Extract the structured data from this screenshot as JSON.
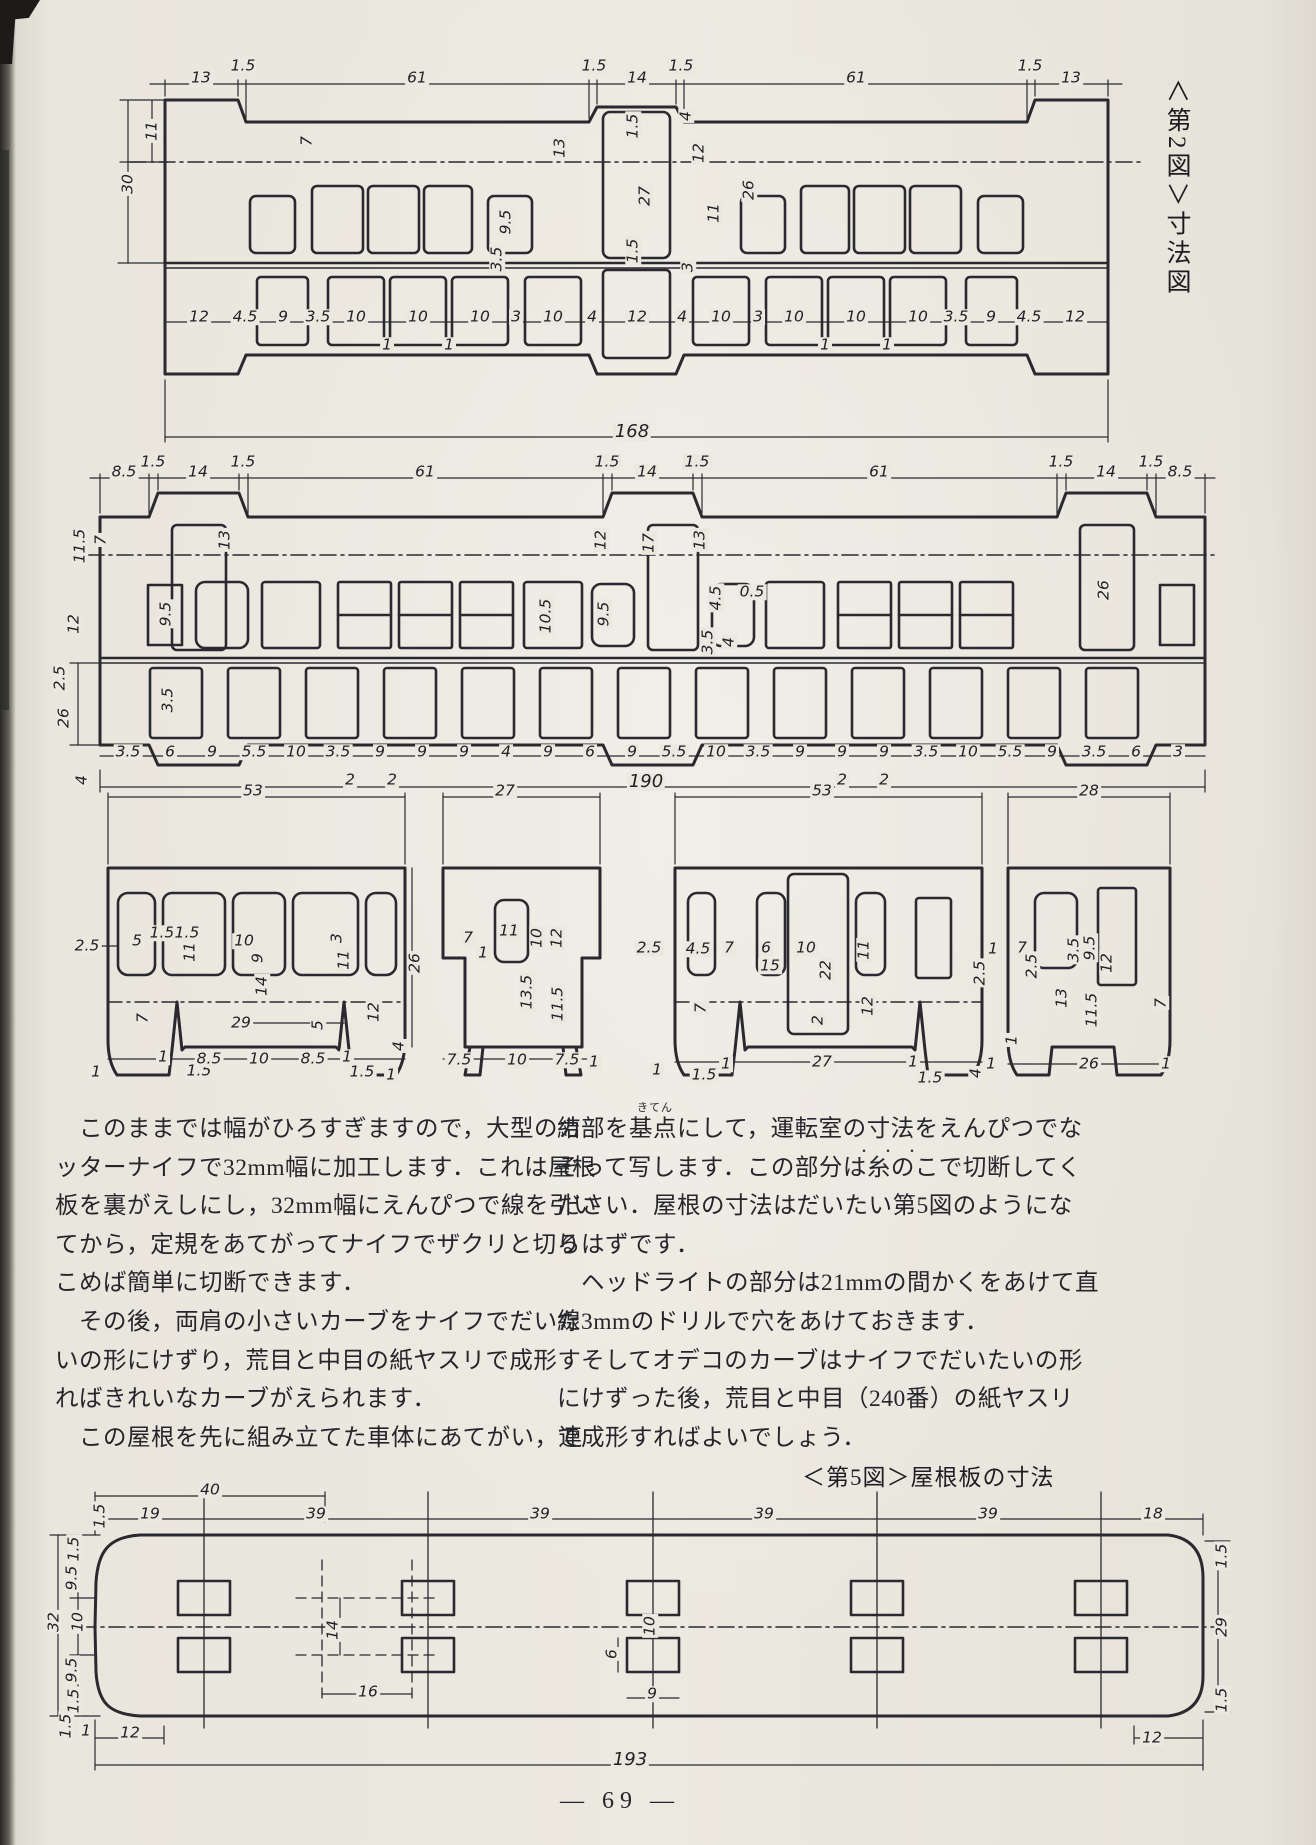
{
  "page": {
    "footer": "— 69 —",
    "ink": "#2a2930",
    "paper": "#e9e6dd"
  },
  "captions": {
    "fig2_vertical": "＜第2図＞寸法図",
    "fig5": "＜第5図＞屋根板の寸法"
  },
  "text": {
    "left_col": [
      "　このままでは幅がひろすぎますので，大型のカ",
      "ッターナイフで32mm幅に加工します．これは屋根",
      "板を裏がえしにし，32mm幅にえんぴつで線を引い",
      "てから，定規をあてがってナイフでザクリと切り",
      "こめば簡単に切断できます．",
      "　その後，両肩の小さいカーブをナイフでだいた",
      "いの形にけずり，荒目と中目の紙ヤスリで成形す",
      "ればきれいなカーブがえられます．",
      "　この屋根を先に組み立てた車体にあてがい，連"
    ],
    "right_col": [
      "結部を基点にして，運転室の寸法をえんぴつでな",
      "ぞって写します．この部分は糸のこで切断してく",
      "ださい．屋根の寸法はだいたい第5図のようにな",
      "るはずです．",
      "　ヘッドライトの部分は21mmの間かくをあけて直",
      "線3mmのドリルで穴をあけておきます．",
      "　そしてオデコのカーブはナイフでだいたいの形",
      "にけずった後，荒目と中目（240番）の紙ヤスリ",
      "で成形すればよいでしょう．"
    ],
    "furigana_kiten": "きてん",
    "emphasis_dots": "・・・"
  },
  "dims": {
    "strip1": [
      {
        "t": "13",
        "x": 201,
        "y": 78
      },
      {
        "t": "1.5",
        "x": 243,
        "y": 66
      },
      {
        "t": "61",
        "x": 417,
        "y": 78
      },
      {
        "t": "1.5",
        "x": 594,
        "y": 66
      },
      {
        "t": "14",
        "x": 637,
        "y": 78
      },
      {
        "t": "1.5",
        "x": 681,
        "y": 66
      },
      {
        "t": "61",
        "x": 856,
        "y": 78
      },
      {
        "t": "1.5",
        "x": 1030,
        "y": 66
      },
      {
        "t": "13",
        "x": 1071,
        "y": 78
      },
      {
        "t": "11",
        "x": 152,
        "y": 131,
        "r": 1
      },
      {
        "t": "30",
        "x": 128,
        "y": 184,
        "r": 1
      },
      {
        "t": "7",
        "x": 307,
        "y": 141,
        "r": 1
      },
      {
        "t": "13",
        "x": 560,
        "y": 148,
        "r": 1
      },
      {
        "t": "9.5",
        "x": 506,
        "y": 222,
        "r": 1
      },
      {
        "t": "3.5",
        "x": 497,
        "y": 259,
        "r": 1
      },
      {
        "t": "1.5",
        "x": 633,
        "y": 126,
        "r": 1
      },
      {
        "t": "27",
        "x": 645,
        "y": 196,
        "r": 1
      },
      {
        "t": "1.5",
        "x": 633,
        "y": 251,
        "r": 1
      },
      {
        "t": "4",
        "x": 686,
        "y": 116,
        "r": 1
      },
      {
        "t": "12",
        "x": 699,
        "y": 153,
        "r": 1
      },
      {
        "t": "11",
        "x": 714,
        "y": 213,
        "r": 1
      },
      {
        "t": "26",
        "x": 749,
        "y": 190,
        "r": 1
      },
      {
        "t": "3",
        "x": 688,
        "y": 267,
        "r": 1
      },
      {
        "t": "12",
        "x": 199,
        "y": 317
      },
      {
        "t": "4.5",
        "x": 245,
        "y": 317
      },
      {
        "t": "9",
        "x": 283,
        "y": 317
      },
      {
        "t": "3.5",
        "x": 318,
        "y": 317
      },
      {
        "t": "10",
        "x": 356,
        "y": 317
      },
      {
        "t": "10",
        "x": 418,
        "y": 317
      },
      {
        "t": "10",
        "x": 480,
        "y": 317
      },
      {
        "t": "3",
        "x": 516,
        "y": 317
      },
      {
        "t": "10",
        "x": 553,
        "y": 317
      },
      {
        "t": "4",
        "x": 592,
        "y": 317
      },
      {
        "t": "12",
        "x": 637,
        "y": 317
      },
      {
        "t": "4",
        "x": 682,
        "y": 317
      },
      {
        "t": "10",
        "x": 721,
        "y": 317
      },
      {
        "t": "3",
        "x": 758,
        "y": 317
      },
      {
        "t": "10",
        "x": 794,
        "y": 317
      },
      {
        "t": "10",
        "x": 856,
        "y": 317
      },
      {
        "t": "10",
        "x": 918,
        "y": 317
      },
      {
        "t": "3.5",
        "x": 956,
        "y": 317
      },
      {
        "t": "9",
        "x": 991,
        "y": 317
      },
      {
        "t": "4.5",
        "x": 1029,
        "y": 317
      },
      {
        "t": "12",
        "x": 1075,
        "y": 317
      },
      {
        "t": "1",
        "x": 387,
        "y": 345
      },
      {
        "t": "1",
        "x": 449,
        "y": 345
      },
      {
        "t": "1",
        "x": 825,
        "y": 345
      },
      {
        "t": "1",
        "x": 887,
        "y": 345
      },
      {
        "t": "168",
        "x": 632,
        "y": 432,
        "s": 1
      }
    ],
    "strip2": [
      {
        "t": "8.5",
        "x": 124,
        "y": 472
      },
      {
        "t": "1.5",
        "x": 153,
        "y": 462
      },
      {
        "t": "14",
        "x": 198,
        "y": 472
      },
      {
        "t": "1.5",
        "x": 243,
        "y": 462
      },
      {
        "t": "61",
        "x": 425,
        "y": 472
      },
      {
        "t": "1.5",
        "x": 607,
        "y": 462
      },
      {
        "t": "14",
        "x": 647,
        "y": 472
      },
      {
        "t": "1.5",
        "x": 697,
        "y": 462
      },
      {
        "t": "61",
        "x": 879,
        "y": 472
      },
      {
        "t": "1.5",
        "x": 1061,
        "y": 462
      },
      {
        "t": "14",
        "x": 1106,
        "y": 472
      },
      {
        "t": "1.5",
        "x": 1151,
        "y": 462
      },
      {
        "t": "8.5",
        "x": 1180,
        "y": 472
      },
      {
        "t": "11.5",
        "x": 80,
        "y": 546,
        "r": 1
      },
      {
        "t": "7",
        "x": 101,
        "y": 540,
        "r": 1
      },
      {
        "t": "13",
        "x": 225,
        "y": 540,
        "r": 1
      },
      {
        "t": "12",
        "x": 74,
        "y": 624,
        "r": 1
      },
      {
        "t": "2.5",
        "x": 60,
        "y": 678,
        "r": 1
      },
      {
        "t": "9.5",
        "x": 166,
        "y": 614,
        "r": 1
      },
      {
        "t": "3.5",
        "x": 168,
        "y": 700,
        "r": 1
      },
      {
        "t": "26",
        "x": 64,
        "y": 718,
        "r": 1
      },
      {
        "t": "4",
        "x": 82,
        "y": 780,
        "r": 1
      },
      {
        "t": "12",
        "x": 601,
        "y": 540,
        "r": 1
      },
      {
        "t": "17",
        "x": 649,
        "y": 543,
        "r": 1
      },
      {
        "t": "13",
        "x": 700,
        "y": 540,
        "r": 1
      },
      {
        "t": "10.5",
        "x": 546,
        "y": 616,
        "r": 1
      },
      {
        "t": "9.5",
        "x": 604,
        "y": 614,
        "r": 1
      },
      {
        "t": "4.5",
        "x": 716,
        "y": 598,
        "r": 1
      },
      {
        "t": "0.5",
        "x": 752,
        "y": 592
      },
      {
        "t": "3.5",
        "x": 708,
        "y": 642,
        "r": 1
      },
      {
        "t": "4",
        "x": 729,
        "y": 642,
        "r": 1
      },
      {
        "t": "26",
        "x": 1104,
        "y": 590,
        "r": 1
      },
      {
        "t": "3.5",
        "x": 128,
        "y": 752
      },
      {
        "t": "6",
        "x": 170,
        "y": 752
      },
      {
        "t": "9",
        "x": 212,
        "y": 752
      },
      {
        "t": "5.5",
        "x": 254,
        "y": 752
      },
      {
        "t": "10",
        "x": 296,
        "y": 752
      },
      {
        "t": "3.5",
        "x": 338,
        "y": 752
      },
      {
        "t": "9",
        "x": 380,
        "y": 752
      },
      {
        "t": "9",
        "x": 422,
        "y": 752
      },
      {
        "t": "9",
        "x": 464,
        "y": 752
      },
      {
        "t": "4",
        "x": 506,
        "y": 752
      },
      {
        "t": "9",
        "x": 548,
        "y": 752
      },
      {
        "t": "6",
        "x": 590,
        "y": 752
      },
      {
        "t": "9",
        "x": 632,
        "y": 752
      },
      {
        "t": "5.5",
        "x": 674,
        "y": 752
      },
      {
        "t": "10",
        "x": 716,
        "y": 752
      },
      {
        "t": "3.5",
        "x": 758,
        "y": 752
      },
      {
        "t": "9",
        "x": 800,
        "y": 752
      },
      {
        "t": "9",
        "x": 842,
        "y": 752
      },
      {
        "t": "9",
        "x": 884,
        "y": 752
      },
      {
        "t": "3.5",
        "x": 926,
        "y": 752
      },
      {
        "t": "10",
        "x": 968,
        "y": 752
      },
      {
        "t": "5.5",
        "x": 1010,
        "y": 752
      },
      {
        "t": "9",
        "x": 1052,
        "y": 752
      },
      {
        "t": "3.5",
        "x": 1094,
        "y": 752
      },
      {
        "t": "6",
        "x": 1136,
        "y": 752
      },
      {
        "t": "3",
        "x": 1178,
        "y": 752
      },
      {
        "t": "2",
        "x": 350,
        "y": 780
      },
      {
        "t": "2",
        "x": 392,
        "y": 780
      },
      {
        "t": "2",
        "x": 842,
        "y": 780
      },
      {
        "t": "2",
        "x": 884,
        "y": 780
      },
      {
        "t": "190",
        "x": 646,
        "y": 782,
        "s": 1
      }
    ],
    "panels": [
      {
        "t": "53",
        "x": 253,
        "y": 791
      },
      {
        "t": "27",
        "x": 505,
        "y": 791
      },
      {
        "t": "53",
        "x": 822,
        "y": 791
      },
      {
        "t": "28",
        "x": 1089,
        "y": 791
      },
      {
        "t": "2.5",
        "x": 87,
        "y": 946
      },
      {
        "t": "5",
        "x": 137,
        "y": 941
      },
      {
        "t": "1.5",
        "x": 162,
        "y": 933
      },
      {
        "t": "1.5",
        "x": 187,
        "y": 933
      },
      {
        "t": "11",
        "x": 190,
        "y": 952,
        "r": 1
      },
      {
        "t": "10",
        "x": 244,
        "y": 941
      },
      {
        "t": "9",
        "x": 258,
        "y": 958,
        "r": 1
      },
      {
        "t": "3",
        "x": 337,
        "y": 938,
        "r": 1
      },
      {
        "t": "11",
        "x": 344,
        "y": 960,
        "r": 1
      },
      {
        "t": "14",
        "x": 262,
        "y": 986,
        "r": 1
      },
      {
        "t": "29",
        "x": 241,
        "y": 1023
      },
      {
        "t": "5",
        "x": 318,
        "y": 1025,
        "r": 1
      },
      {
        "t": "7",
        "x": 143,
        "y": 1018,
        "r": 1
      },
      {
        "t": "12",
        "x": 374,
        "y": 1012,
        "r": 1
      },
      {
        "t": "26",
        "x": 415,
        "y": 963,
        "r": 1
      },
      {
        "t": "1",
        "x": 96,
        "y": 1072
      },
      {
        "t": "1.5",
        "x": 199,
        "y": 1071
      },
      {
        "t": "1",
        "x": 163,
        "y": 1057
      },
      {
        "t": "8.5",
        "x": 209,
        "y": 1059
      },
      {
        "t": "10",
        "x": 259,
        "y": 1059
      },
      {
        "t": "8.5",
        "x": 313,
        "y": 1059
      },
      {
        "t": "1",
        "x": 347,
        "y": 1057
      },
      {
        "t": "1.5",
        "x": 362,
        "y": 1072
      },
      {
        "t": "1",
        "x": 391,
        "y": 1075
      },
      {
        "t": "4",
        "x": 399,
        "y": 1046,
        "r": 1
      },
      {
        "t": "7",
        "x": 468,
        "y": 938
      },
      {
        "t": "11",
        "x": 509,
        "y": 931
      },
      {
        "t": "10",
        "x": 537,
        "y": 938,
        "r": 1
      },
      {
        "t": "1",
        "x": 483,
        "y": 953
      },
      {
        "t": "12",
        "x": 557,
        "y": 938,
        "r": 1
      },
      {
        "t": "13.5",
        "x": 527,
        "y": 992,
        "r": 1
      },
      {
        "t": "11.5",
        "x": 558,
        "y": 1004,
        "r": 1
      },
      {
        "t": "7.5",
        "x": 459,
        "y": 1060
      },
      {
        "t": "10",
        "x": 517,
        "y": 1060
      },
      {
        "t": "7.5",
        "x": 567,
        "y": 1060
      },
      {
        "t": "1",
        "x": 594,
        "y": 1062
      },
      {
        "t": "2.5",
        "x": 649,
        "y": 948
      },
      {
        "t": "4.5",
        "x": 698,
        "y": 949
      },
      {
        "t": "7",
        "x": 729,
        "y": 948
      },
      {
        "t": "6",
        "x": 766,
        "y": 948
      },
      {
        "t": "15",
        "x": 770,
        "y": 966
      },
      {
        "t": "10",
        "x": 806,
        "y": 948
      },
      {
        "t": "22",
        "x": 826,
        "y": 970,
        "r": 1
      },
      {
        "t": "2",
        "x": 818,
        "y": 1020,
        "r": 1
      },
      {
        "t": "11",
        "x": 864,
        "y": 950,
        "r": 1
      },
      {
        "t": "12",
        "x": 868,
        "y": 1006,
        "r": 1
      },
      {
        "t": "7",
        "x": 701,
        "y": 1008,
        "r": 1
      },
      {
        "t": "2.5",
        "x": 980,
        "y": 973,
        "r": 1
      },
      {
        "t": "1",
        "x": 993,
        "y": 949
      },
      {
        "t": "1",
        "x": 657,
        "y": 1070
      },
      {
        "t": "1.5",
        "x": 704,
        "y": 1075
      },
      {
        "t": "1",
        "x": 726,
        "y": 1064
      },
      {
        "t": "27",
        "x": 822,
        "y": 1062
      },
      {
        "t": "1",
        "x": 913,
        "y": 1062
      },
      {
        "t": "1.5",
        "x": 930,
        "y": 1078
      },
      {
        "t": "4",
        "x": 976,
        "y": 1073,
        "r": 1
      },
      {
        "t": "1",
        "x": 991,
        "y": 1064
      },
      {
        "t": "7",
        "x": 1022,
        "y": 948
      },
      {
        "t": "2.5",
        "x": 1032,
        "y": 966,
        "r": 1
      },
      {
        "t": "9.5",
        "x": 1090,
        "y": 948,
        "r": 1
      },
      {
        "t": "3.5",
        "x": 1074,
        "y": 950,
        "r": 1
      },
      {
        "t": "13",
        "x": 1062,
        "y": 998,
        "r": 1
      },
      {
        "t": "12",
        "x": 1107,
        "y": 963,
        "r": 1
      },
      {
        "t": "11.5",
        "x": 1092,
        "y": 1010,
        "r": 1
      },
      {
        "t": "7",
        "x": 1161,
        "y": 1003,
        "r": 1
      },
      {
        "t": "26",
        "x": 1089,
        "y": 1064
      },
      {
        "t": "1",
        "x": 1166,
        "y": 1064
      },
      {
        "t": "1",
        "x": 1012,
        "y": 1040,
        "r": 1
      }
    ],
    "roof": [
      {
        "t": "40",
        "x": 210,
        "y": 1490
      },
      {
        "t": "1.5",
        "x": 100,
        "y": 1516,
        "r": 1
      },
      {
        "t": "19",
        "x": 150,
        "y": 1514
      },
      {
        "t": "39",
        "x": 316,
        "y": 1514
      },
      {
        "t": "39",
        "x": 540,
        "y": 1514
      },
      {
        "t": "39",
        "x": 764,
        "y": 1514
      },
      {
        "t": "39",
        "x": 988,
        "y": 1514
      },
      {
        "t": "18",
        "x": 1153,
        "y": 1514
      },
      {
        "t": "1.5",
        "x": 74,
        "y": 1549,
        "r": 1
      },
      {
        "t": "9.5",
        "x": 72,
        "y": 1578,
        "r": 1
      },
      {
        "t": "10",
        "x": 78,
        "y": 1622,
        "r": 1
      },
      {
        "t": "32",
        "x": 54,
        "y": 1622,
        "r": 1
      },
      {
        "t": "9.5",
        "x": 72,
        "y": 1670,
        "r": 1
      },
      {
        "t": "1.5",
        "x": 74,
        "y": 1701,
        "r": 1
      },
      {
        "t": "14",
        "x": 333,
        "y": 1630,
        "r": 1
      },
      {
        "t": "16",
        "x": 368,
        "y": 1692
      },
      {
        "t": "10",
        "x": 650,
        "y": 1626,
        "r": 1
      },
      {
        "t": "6",
        "x": 612,
        "y": 1654,
        "r": 1
      },
      {
        "t": "9",
        "x": 652,
        "y": 1694
      },
      {
        "t": "1.5",
        "x": 1222,
        "y": 1556,
        "r": 1
      },
      {
        "t": "29",
        "x": 1222,
        "y": 1627,
        "r": 1
      },
      {
        "t": "1.5",
        "x": 1222,
        "y": 1700,
        "r": 1
      },
      {
        "t": "1",
        "x": 86,
        "y": 1731
      },
      {
        "t": "12",
        "x": 130,
        "y": 1733
      },
      {
        "t": "1.5",
        "x": 66,
        "y": 1726,
        "r": 1
      },
      {
        "t": "12",
        "x": 1152,
        "y": 1738
      },
      {
        "t": "193",
        "x": 630,
        "y": 1760,
        "s": 1
      }
    ]
  }
}
